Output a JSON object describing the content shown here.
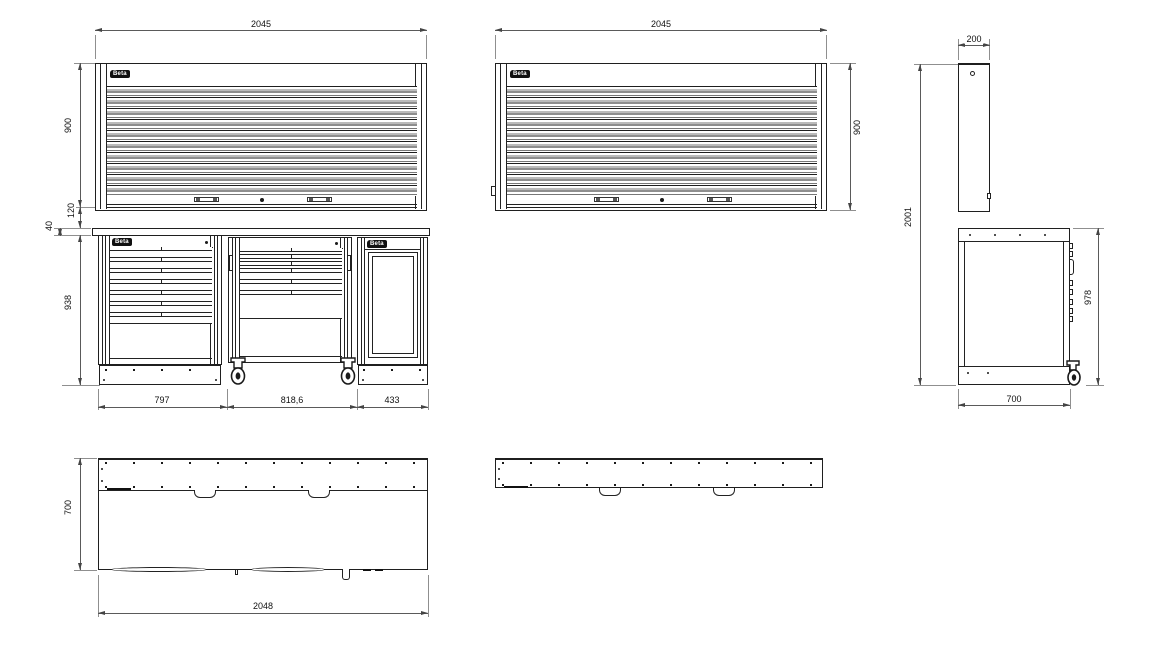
{
  "brand": "Beta",
  "views": {
    "front_left": {
      "width": "2045",
      "shutter_height": "900",
      "gap": "120",
      "worktop_thickness": "40",
      "base_height": "938",
      "cabinet1_width": "797",
      "cabinet2_width": "818,6",
      "cabinet3_width": "433"
    },
    "front_middle": {
      "width": "2045",
      "shutter_height": "900"
    },
    "side": {
      "wall_unit_depth": "200",
      "overall_height": "2001",
      "bench_height": "978",
      "bench_depth": "700"
    },
    "plan": {
      "depth": "700",
      "width": "2048"
    }
  }
}
